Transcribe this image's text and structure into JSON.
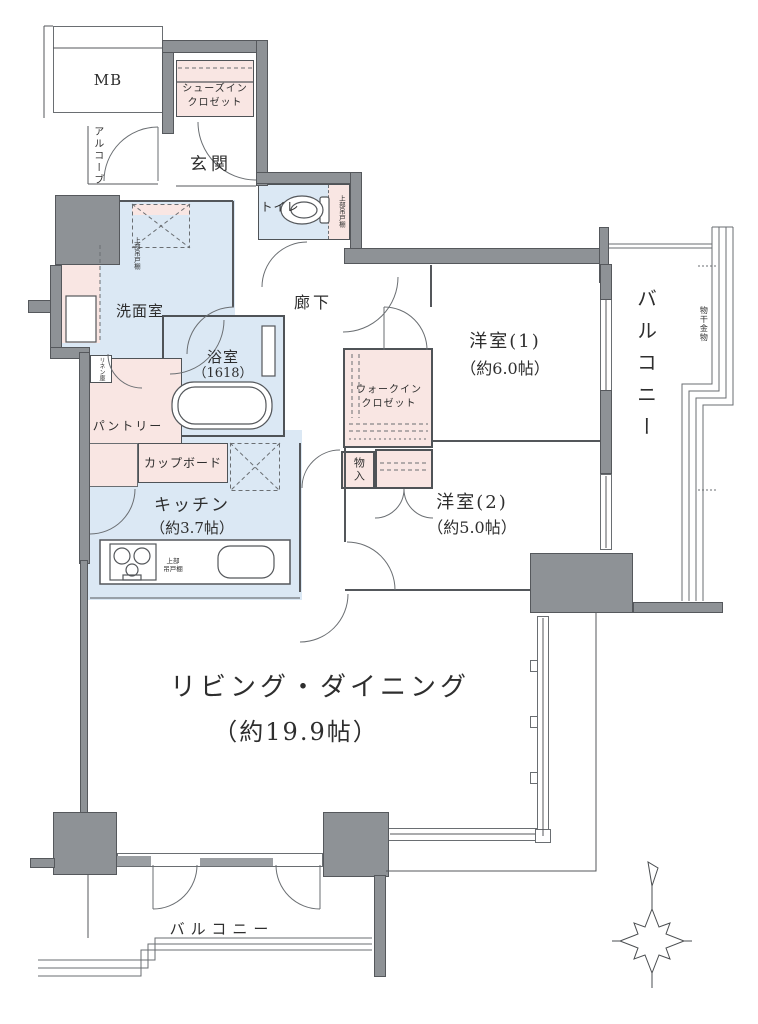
{
  "colors": {
    "wall": "#8e9296",
    "room_pink": "#f9e6e3",
    "room_blue": "#dbe8f4",
    "line": "#54575b",
    "text": "#2e2e2e"
  },
  "rooms": {
    "mb": {
      "label": "MB"
    },
    "alcove": {
      "label": "アルコーブ"
    },
    "shoes_closet": {
      "label": "シューズイン\nクロゼット"
    },
    "entrance": {
      "label": "玄関"
    },
    "toilet": {
      "label": "トイレ"
    },
    "toilet_shelf": {
      "label": "上部吊戸棚"
    },
    "corridor": {
      "label": "廊下"
    },
    "washroom": {
      "label": "洗面室"
    },
    "washroom_shelf": {
      "label": "上部吊戸棚"
    },
    "linen": {
      "label": "リネン庫"
    },
    "bathroom": {
      "label": "浴室",
      "size": "（1618）"
    },
    "pantry": {
      "label": "パントリー"
    },
    "cupboard": {
      "label": "カップボード"
    },
    "kitchen": {
      "label": "キッチン",
      "size": "（約3.7帖）"
    },
    "kitchen_shelf": {
      "label": "上部\n吊戸棚"
    },
    "walk_in_closet": {
      "label": "ウォークイン\nクロゼット"
    },
    "storage": {
      "label": "物入"
    },
    "bedroom1": {
      "label": "洋室(1)",
      "size": "（約6.0帖）"
    },
    "bedroom2": {
      "label": "洋室(2)",
      "size": "（約5.0帖）"
    },
    "living_dining": {
      "label": "リビング・ダイニング",
      "size": "（約19.9帖）"
    },
    "balcony_east": {
      "label": "バルコニー"
    },
    "balcony_south": {
      "label": "バルコニー"
    },
    "laundry_hardware": {
      "label": "物干金物"
    }
  }
}
